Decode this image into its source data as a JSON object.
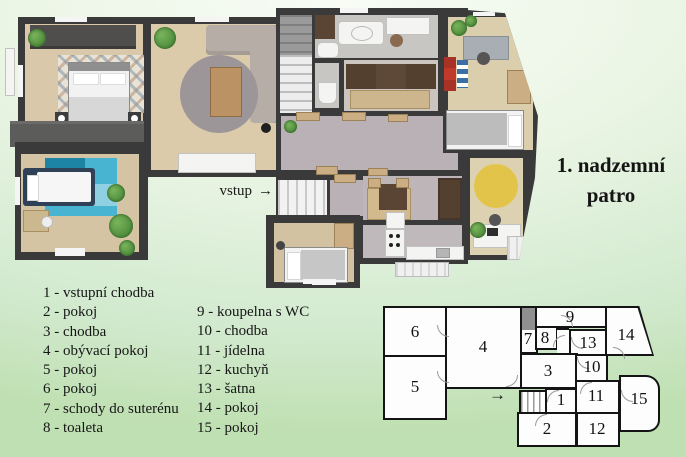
{
  "title": {
    "line1": "1. nadzemní",
    "line2": "patro"
  },
  "plan3d": {
    "entrance_label": "vstup",
    "entrance_arrow": "→"
  },
  "legend": {
    "col1": [
      "1 - vstupní chodba",
      "2 - pokoj",
      "3 - chodba",
      "4 - obývací pokoj",
      "5 - pokoj",
      "6 - pokoj",
      "7 - schody do suterénu",
      "8 - toaleta"
    ],
    "col2": [
      "9 - koupelna s WC",
      "10 - chodba",
      "11 - jídelna",
      "12 - kuchyň",
      "13 - šatna",
      "14 - pokoj",
      "15 - pokoj"
    ]
  },
  "schematic": {
    "entry_arrow": "→",
    "room_numbers": [
      "1",
      "2",
      "3",
      "4",
      "5",
      "6",
      "7",
      "8",
      "9",
      "10",
      "11",
      "12",
      "13",
      "14",
      "15"
    ]
  },
  "colors": {
    "background_top": "#f8fcf5",
    "background_bottom": "#bfe0b2",
    "wall": "#3a3a3a",
    "wood_floor": "#d9c8a9",
    "hall_floor": "#b9b1b5",
    "bath_floor": "#c8c6c2",
    "teal_rug": "#2a9cbf",
    "yellow_rug": "#e3c44b",
    "gray_rug": "#9c9699",
    "sofa": "#b6aea6",
    "plant": "#4a8f3c",
    "red_shelf": "#c0392b",
    "schematic_wall": "#141414",
    "schematic_room_fill": "#fdfdfd",
    "schematic_stairs_fill": "#8f8f8f"
  }
}
